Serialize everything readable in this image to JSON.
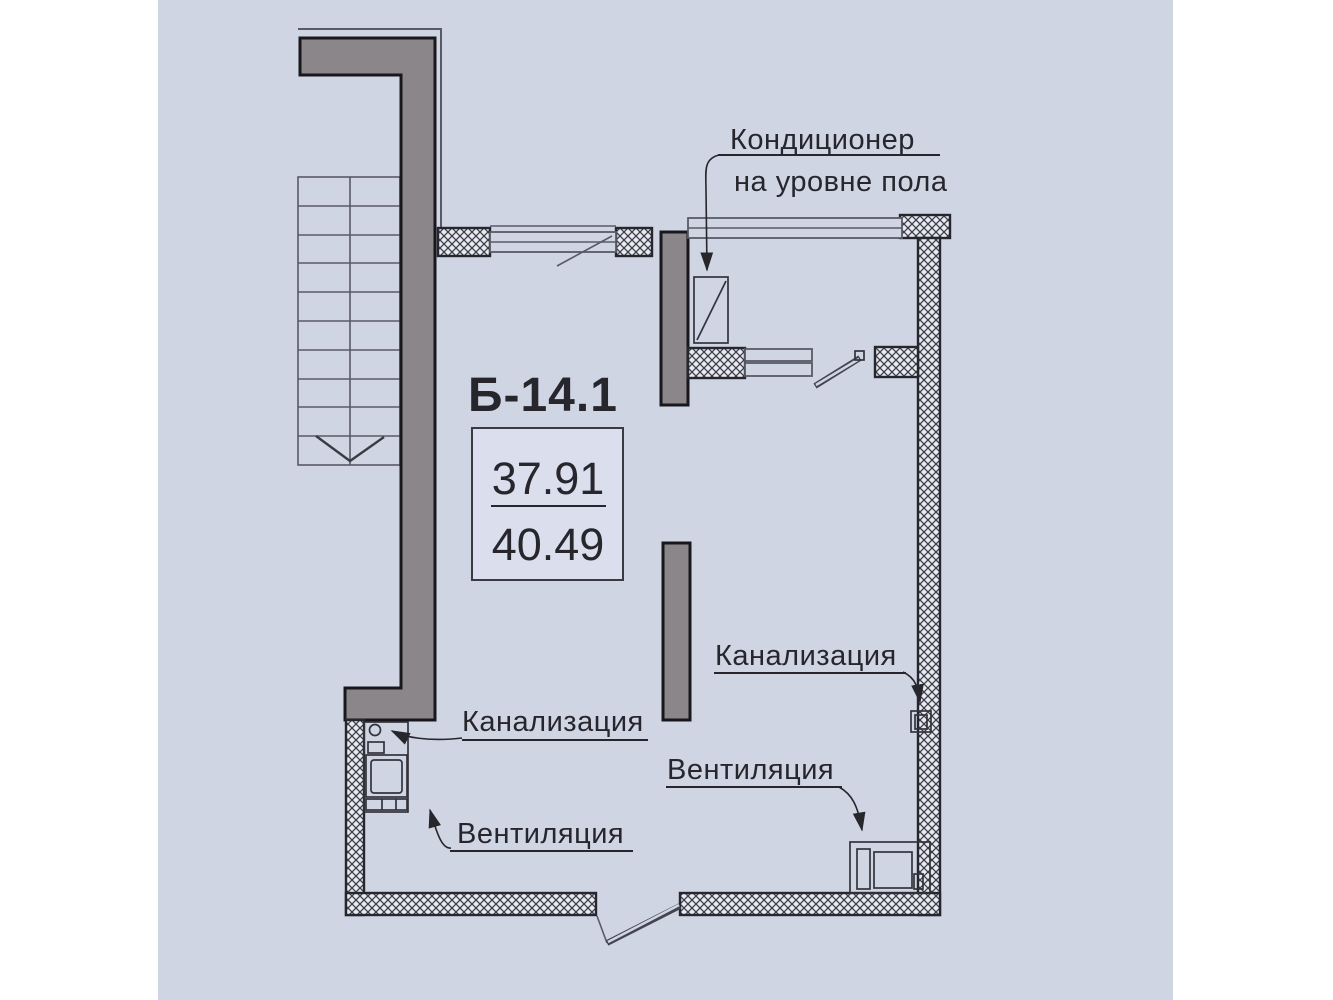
{
  "plan": {
    "unit_label": "Б-14.1",
    "area_box": {
      "living_area": "37.91",
      "total_area": "40.49"
    },
    "annotations": {
      "ac_line1": "Кондиционер",
      "ac_line2": "на уровне пола",
      "sewer_left": "Канализация",
      "sewer_right": "Канализация",
      "vent_left": "Вентиляция",
      "vent_right": "Вентиляция"
    },
    "colors": {
      "paper": "#d0d5e4",
      "wall_dark": "#8b8689",
      "ink": "#26262c"
    }
  }
}
